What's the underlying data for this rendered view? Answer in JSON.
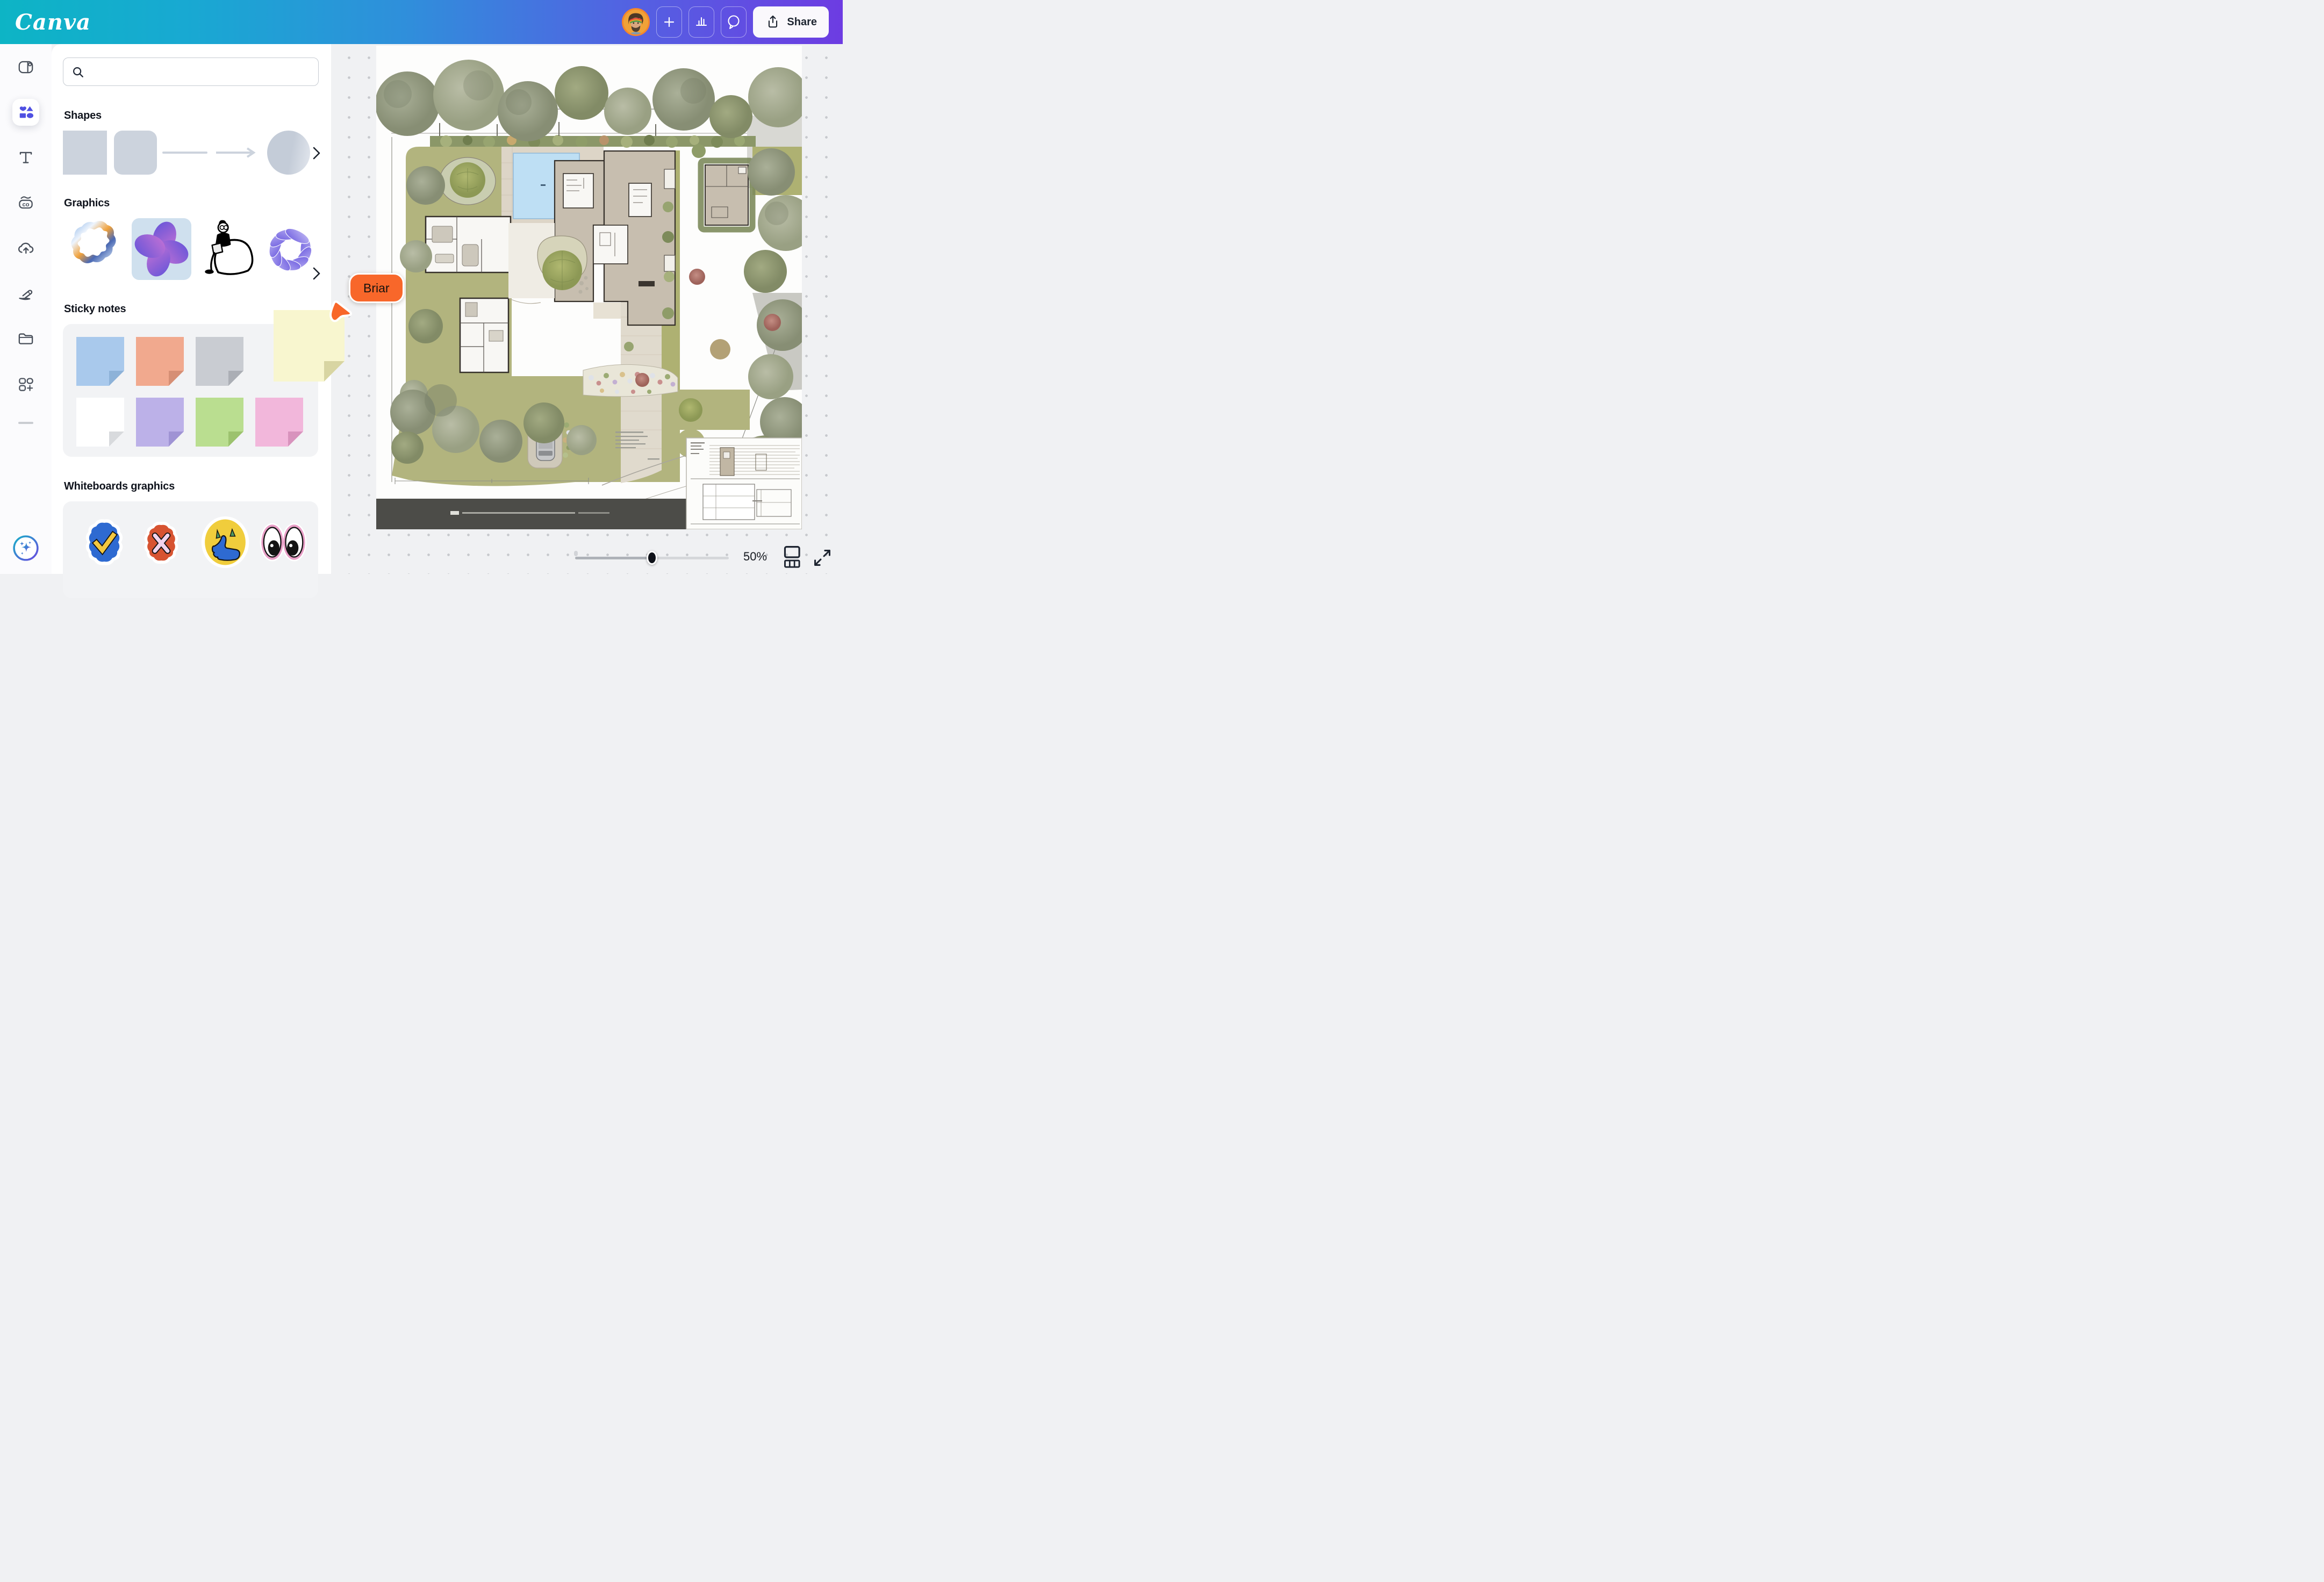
{
  "topbar": {
    "logo": "Canva",
    "share_label": "Share",
    "buttons": [
      "add",
      "insights",
      "comments",
      "share"
    ]
  },
  "sidebar": {
    "active_item": "elements",
    "items": [
      "templates",
      "elements",
      "text",
      "brand",
      "uploads",
      "draw",
      "projects",
      "apps",
      "canva-ai"
    ]
  },
  "panel": {
    "search": {
      "placeholder": ""
    },
    "sections": [
      {
        "title": "Shapes"
      },
      {
        "title": "Graphics"
      },
      {
        "title": "Sticky notes"
      },
      {
        "title": "Whiteboards graphics"
      }
    ],
    "shapes_row": [
      "square",
      "rounded-square",
      "line",
      "arrow-line",
      "circle"
    ],
    "graphics_row": [
      "chrome-blob",
      "purple-flower",
      "person-on-beanbag",
      "purple-torus"
    ],
    "sticky_notes": {
      "row1": [
        {
          "name": "blue",
          "color": "#a9c9ec",
          "fold": "#8db2d8"
        },
        {
          "name": "salmon",
          "color": "#f1a98e",
          "fold": "#d68f75"
        },
        {
          "name": "gray",
          "color": "#c9ccd2",
          "fold": "#abaeb5"
        }
      ],
      "row2": [
        {
          "name": "white",
          "color": "#ffffff",
          "fold": "#d8dadd"
        },
        {
          "name": "purple",
          "color": "#bcb1e8",
          "fold": "#9f93d4"
        },
        {
          "name": "green",
          "color": "#bade90",
          "fold": "#9cc26e"
        },
        {
          "name": "pink",
          "color": "#f2b7db",
          "fold": "#d893bd"
        }
      ]
    },
    "stickers_row": [
      "check-badge",
      "x-badge",
      "thumbs-up",
      "eyes"
    ]
  },
  "collaborator": {
    "name": "Briar",
    "color": "#f8672a"
  },
  "canvas": {
    "content": "architectural site plan",
    "zoom_label": "50%",
    "zoom_fraction": 0.5,
    "dragged_note": {
      "name": "yellow",
      "color": "#f8f6cf",
      "fold": "#d8d5a2"
    }
  }
}
